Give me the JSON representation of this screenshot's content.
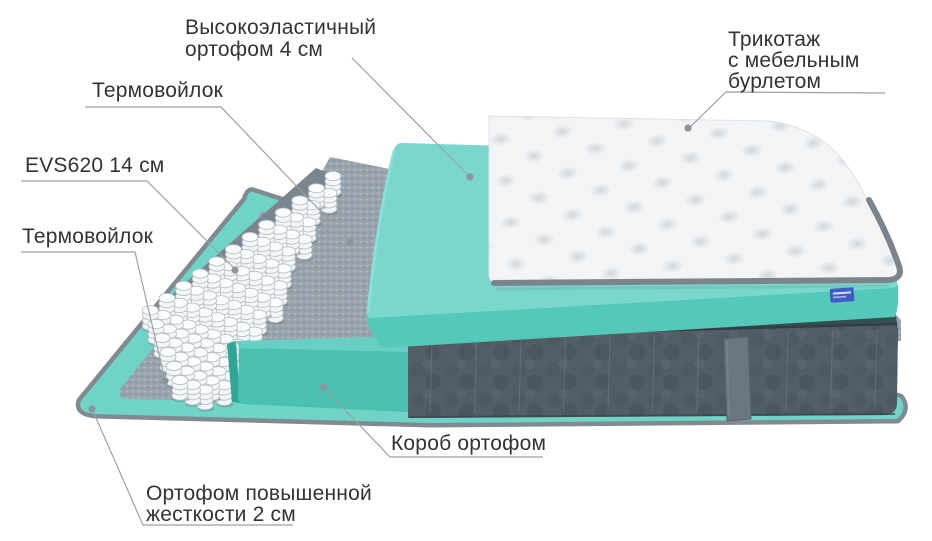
{
  "canvas": {
    "width": 932,
    "height": 541,
    "background": "#ffffff"
  },
  "diagram": {
    "kind": "mattress-layers-exploded-view"
  },
  "labels": [
    {
      "id": "top-foam",
      "lines": [
        "Высокоэластичный",
        "ортофом 4 см"
      ]
    },
    {
      "id": "knit-cover",
      "lines": [
        "Трикотаж",
        "с мебельным",
        "бурлетом"
      ]
    },
    {
      "id": "thermofelt-upper",
      "lines": [
        "Термовойлок"
      ]
    },
    {
      "id": "springs",
      "lines": [
        "EVS620 14 см"
      ]
    },
    {
      "id": "thermofelt-lower",
      "lines": [
        "Термовойлок"
      ]
    },
    {
      "id": "foam-box",
      "lines": [
        "Короб ортофом"
      ]
    },
    {
      "id": "base-foam",
      "lines": [
        "Ортофом повышенной",
        "жесткости 2 см"
      ]
    }
  ],
  "colors": {
    "label_text": "#333333",
    "leader_line": "#9aa1a7",
    "foam_teal_top": "#79d8cb",
    "foam_teal_front": "#54c8b9",
    "sheet_teal": "#6fd3c6",
    "rim_grey": "#7f8b91",
    "box_teal_top": "#68d0c2",
    "box_teal_front": "#49c0b0",
    "box_teal_side": "#2fa695",
    "felt_grey": "#98a3ac",
    "felt_dark_strip": "#354e52",
    "base_dark_grey": "#525d66",
    "base_seam": "#6c7781",
    "strap_grey": "#6b7680",
    "quilt_white": "#f2f4f6",
    "quilt_piping": "#7b848b",
    "spring_white": "#f3f6f8",
    "spring_stroke": "#b3bdc5",
    "brand_tag_blue": "#3f5dc4"
  }
}
